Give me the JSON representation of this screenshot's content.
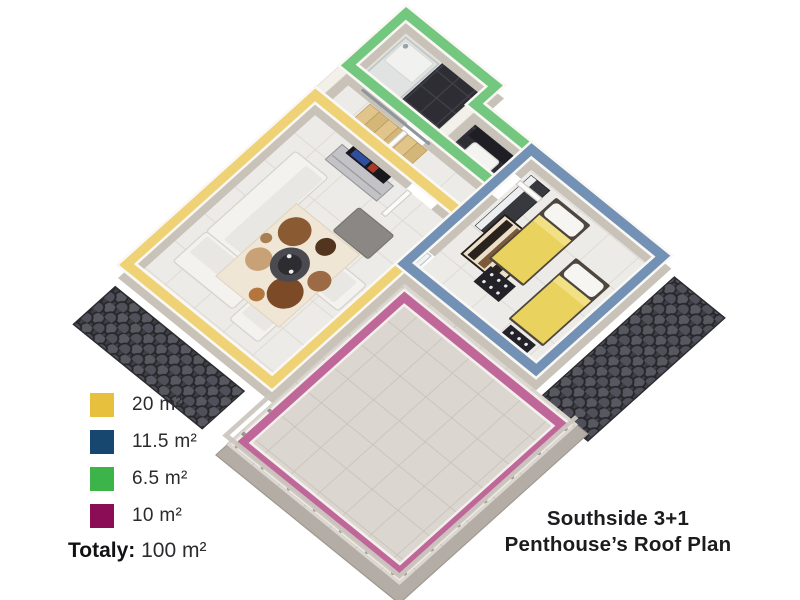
{
  "title": {
    "line1": "Southside 3+1",
    "line2": "Penthouse’s Roof Plan"
  },
  "legend": {
    "total_label": "Totaly:",
    "total_value": "100 m²",
    "items": [
      {
        "room": "living-room",
        "label": "20 m²",
        "color": "#E7C13D",
        "band_color": "#EFD276"
      },
      {
        "room": "bedroom",
        "label": "11.5 m²",
        "color": "#17476E",
        "band_color": "#7391B4"
      },
      {
        "room": "bathroom",
        "label": "6.5 m²",
        "color": "#3CB44A",
        "band_color": "#74C77E"
      },
      {
        "room": "terrace",
        "label": "10 m²",
        "color": "#8A0D55",
        "band_color": "#C0679A"
      }
    ]
  },
  "colors": {
    "wall_top": "#f3f0ea",
    "wall_side": "#c8c2b9",
    "floor_tile": "#ecebe7",
    "terrace_tile": "#dbd6cf",
    "dark_tile": "#2d2d33",
    "roof_tile": "#3e3e45",
    "bed_blanket": "#EAD25E",
    "wood_stairs": "#DFC287"
  }
}
